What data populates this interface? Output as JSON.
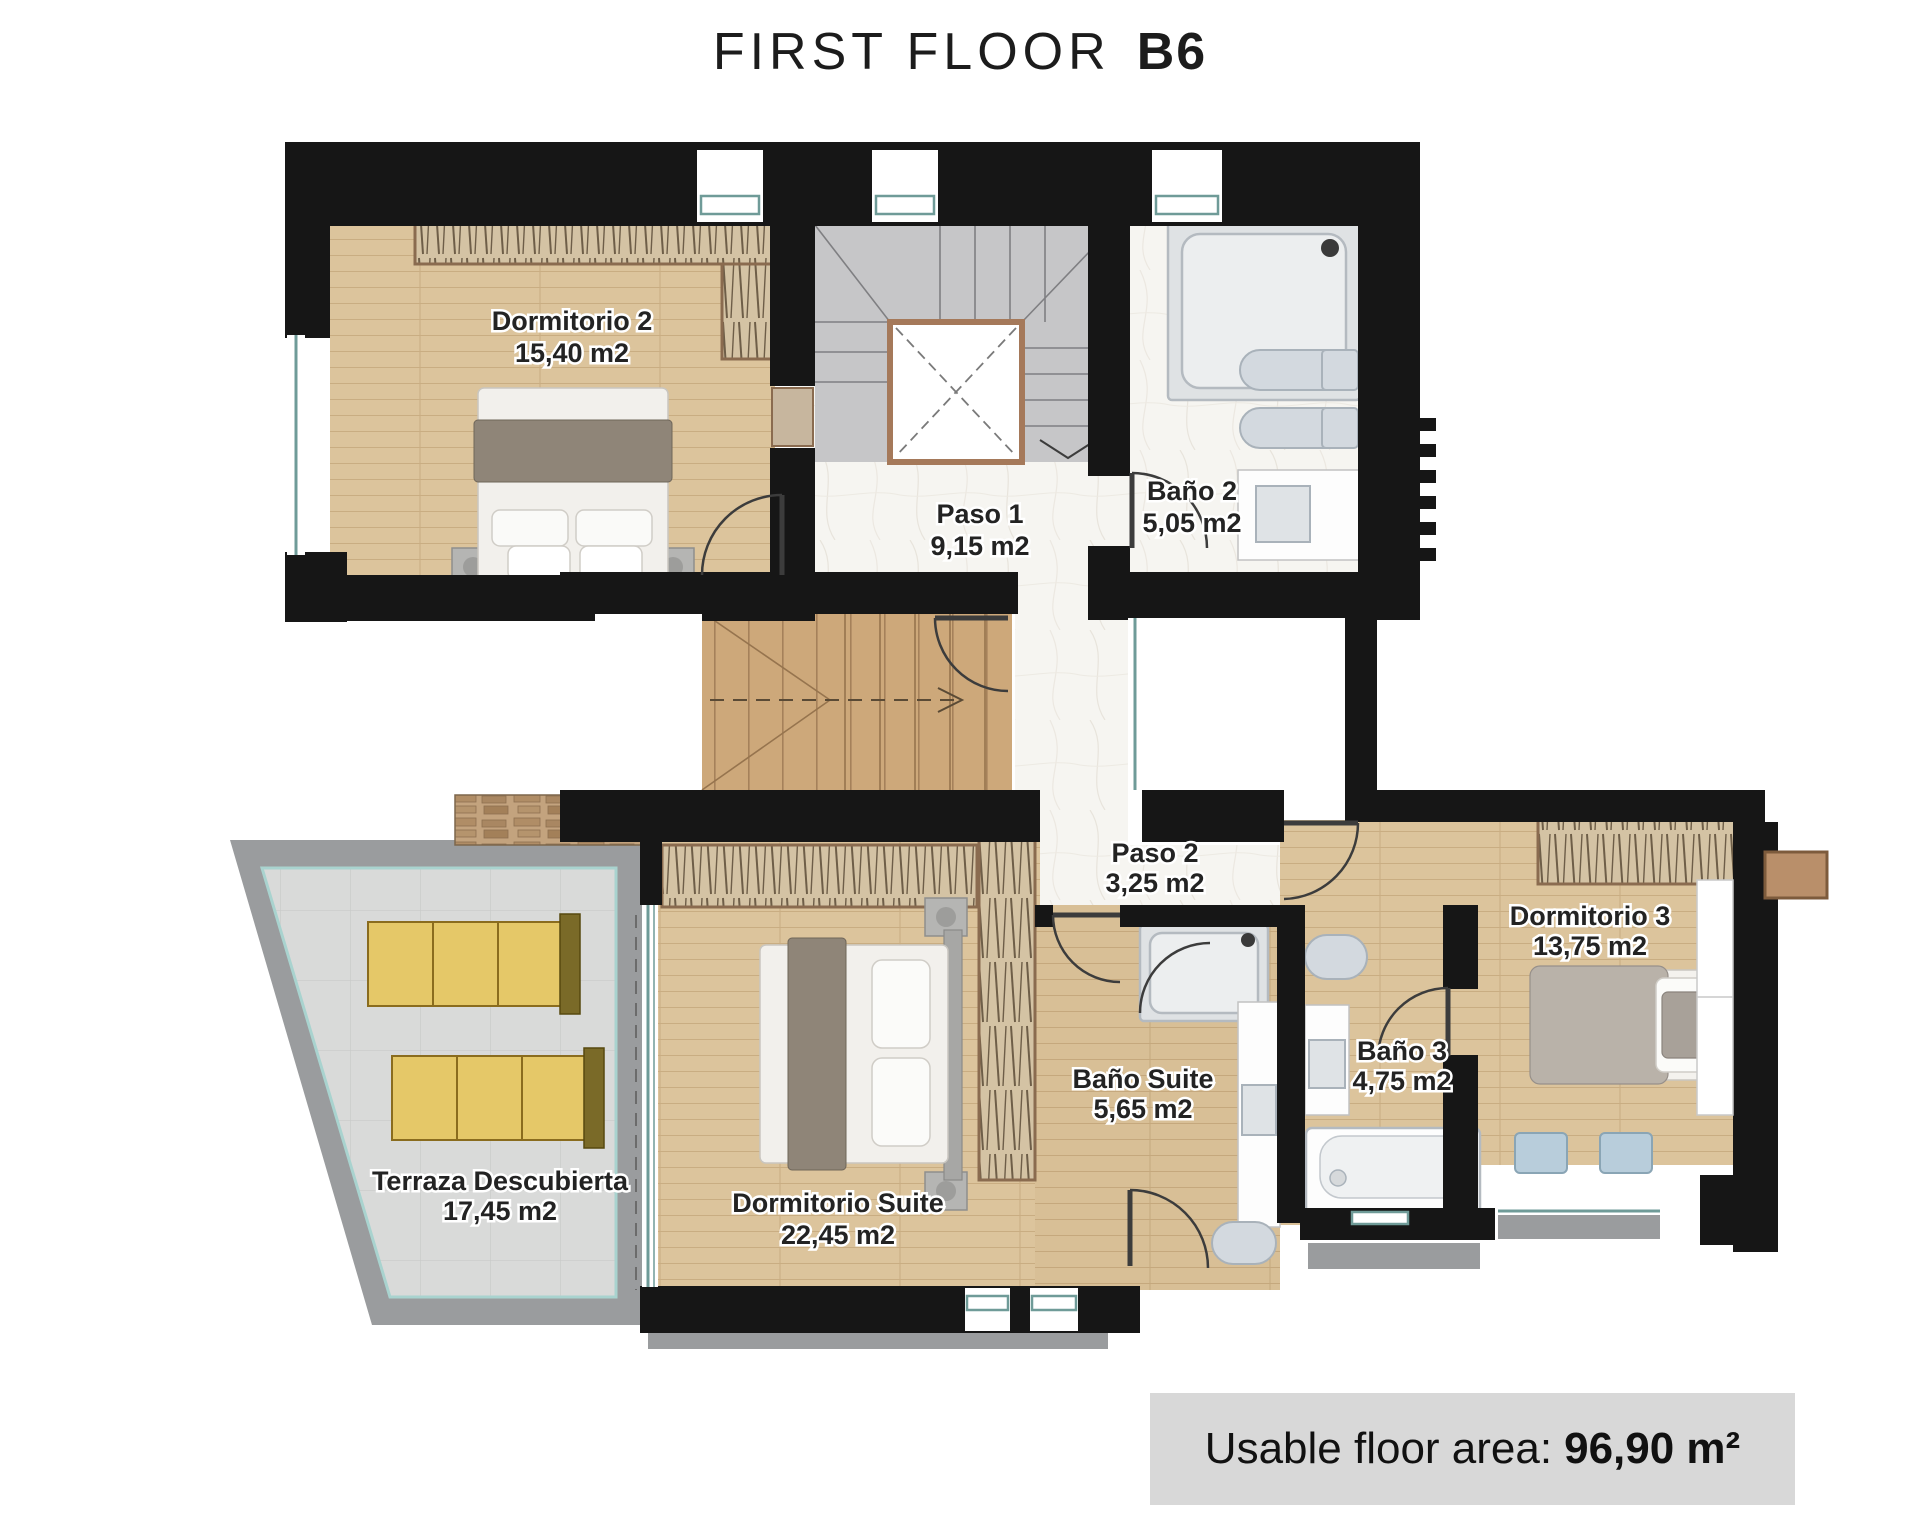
{
  "title": {
    "floor": "FIRST FLOOR",
    "unit": "B6"
  },
  "rooms": [
    {
      "id": "dormitorio-2",
      "name": "Dormitorio 2",
      "area": "15,40 m2"
    },
    {
      "id": "paso-1",
      "name": "Paso 1",
      "area": "9,15 m2"
    },
    {
      "id": "bano-2",
      "name": "Baño 2",
      "area": "5,05 m2"
    },
    {
      "id": "paso-2",
      "name": "Paso 2",
      "area": "3,25 m2"
    },
    {
      "id": "dormitorio-3",
      "name": "Dormitorio 3",
      "area": "13,75 m2"
    },
    {
      "id": "bano-3",
      "name": "Baño 3",
      "area": "4,75 m2"
    },
    {
      "id": "bano-suite",
      "name": "Baño Suite",
      "area": "5,65 m2"
    },
    {
      "id": "dormitorio-suite",
      "name": "Dormitorio Suite",
      "area": "22,45 m2"
    },
    {
      "id": "terraza",
      "name": "Terraza Descubierta",
      "area": "17,45 m2"
    }
  ],
  "summary": {
    "label": "Usable floor area:",
    "value": "96,90 m²"
  },
  "colors": {
    "wall": "#161616",
    "wood_floor": "#dcc49c",
    "stair_wood": "#cda87a",
    "stair_gray": "#c6c6c8",
    "marble": "#f6f5f1",
    "terrace_tile": "#d9dad9",
    "terrace_edge": "#9a9c9e",
    "window_teal": "#9fc9c6",
    "wardrobe_tan": "#d4c3a4",
    "lounger_yellow": "#e5c868",
    "summary_box": "#d8d8d8"
  }
}
